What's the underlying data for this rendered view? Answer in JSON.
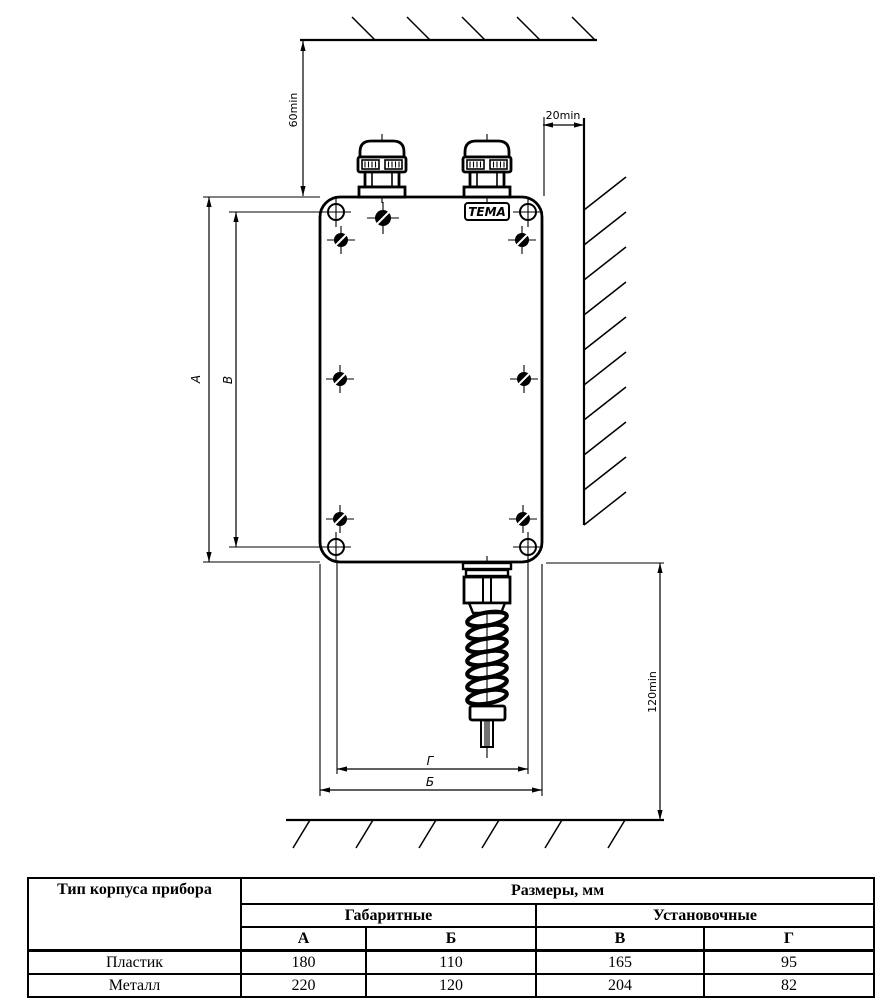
{
  "drawing": {
    "brand": "ТЕМА",
    "dims": {
      "top_clearance": "60min",
      "side_clearance": "20min",
      "bottom_clearance": "120min",
      "overall_height": "А",
      "mounting_height": "В",
      "mounting_width": "Г",
      "overall_width": "Б"
    }
  },
  "table": {
    "type_header": "Тип корпуса прибора",
    "sizes_header": "Размеры, мм",
    "groups": [
      "Габаритные",
      "Установочные"
    ],
    "columns": [
      "А",
      "Б",
      "В",
      "Г"
    ],
    "rows": [
      {
        "type": "Пластик",
        "values": [
          "180",
          "110",
          "165",
          "95"
        ]
      },
      {
        "type": "Металл",
        "values": [
          "220",
          "120",
          "204",
          "82"
        ]
      }
    ]
  }
}
